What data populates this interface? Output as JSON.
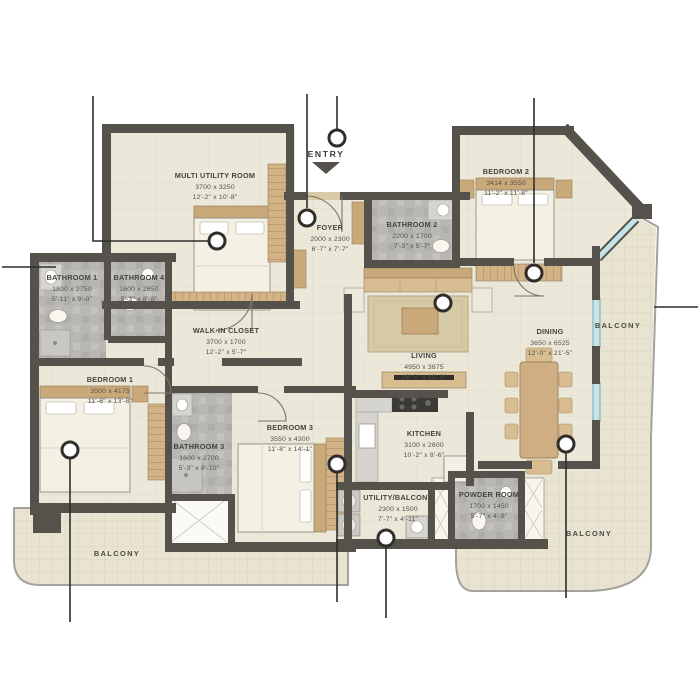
{
  "colors": {
    "wall": "#54524a",
    "floor": "#ebe8d9",
    "bathroom_floor": "#b8b7b4",
    "balcony_floor": "#e9e4d1",
    "glazing": "#c4e4e9",
    "wood": "#cfae83",
    "marker": "#2f2e2a"
  },
  "entry": {
    "label": "ENTRY"
  },
  "rooms": {
    "multi_utility": {
      "name": "MULTI UTILITY ROOM",
      "mm": "3700 x 3250",
      "ft": "12'-2\" x 10'-8\""
    },
    "foyer": {
      "name": "FOYER",
      "mm": "2000 x 2300",
      "ft": "6'-7\" x 7'-7\""
    },
    "bathroom_2": {
      "name": "BATHROOM 2",
      "mm": "2200 x 1700",
      "ft": "7'-3\" x 5'-7\""
    },
    "bedroom_2": {
      "name": "BEDROOM 2",
      "mm": "3414 x 3550",
      "ft": "11'-2\" x 11'-8\""
    },
    "bathroom_1": {
      "name": "BATHROOM 1",
      "mm": "1800 x 2750",
      "ft": "5'-11\" x 9'-0\""
    },
    "bathroom_4": {
      "name": "BATHROOM 4",
      "mm": "1600 x 2650",
      "ft": "5'-3\" x 8'-8\""
    },
    "walk_in_closet": {
      "name": "WALK-IN CLOSET",
      "mm": "3700 x 1700",
      "ft": "12'-2\" x 5'-7\""
    },
    "bedroom_1": {
      "name": "BEDROOM 1",
      "mm": "3500 x 4175",
      "ft": "11'-6\" x 13'-8\""
    },
    "bathroom_3": {
      "name": "BATHROOM 3",
      "mm": "1600 x 2700",
      "ft": "5'-3\" x 8'-10\""
    },
    "bedroom_3": {
      "name": "BEDROOM 3",
      "mm": "3550 x 4300",
      "ft": "11'-8\" x 14'-1\""
    },
    "living": {
      "name": "LIVING",
      "mm": "4950 x 3875",
      "ft": "16'-3\" x 12'-9\""
    },
    "kitchen": {
      "name": "KITCHEN",
      "mm": "3100 x 2600",
      "ft": "10'-2\" x 8'-6\""
    },
    "utility_balcony": {
      "name": "UTILITY/BALCONY",
      "mm": "2300 x 1500",
      "ft": "7'-7\" x 4'-11\""
    },
    "powder_room": {
      "name": "POWDER ROOM",
      "mm": "1700 x 1450",
      "ft": "5'-7\" x 4'-9\""
    },
    "dining": {
      "name": "DINING",
      "mm": "3650 x 6525",
      "ft": "12'-0\" x 21'-5\""
    }
  },
  "balconies": {
    "right": "BALCONY",
    "bottom_right": "BALCONY",
    "bottom_left": "BALCONY"
  }
}
